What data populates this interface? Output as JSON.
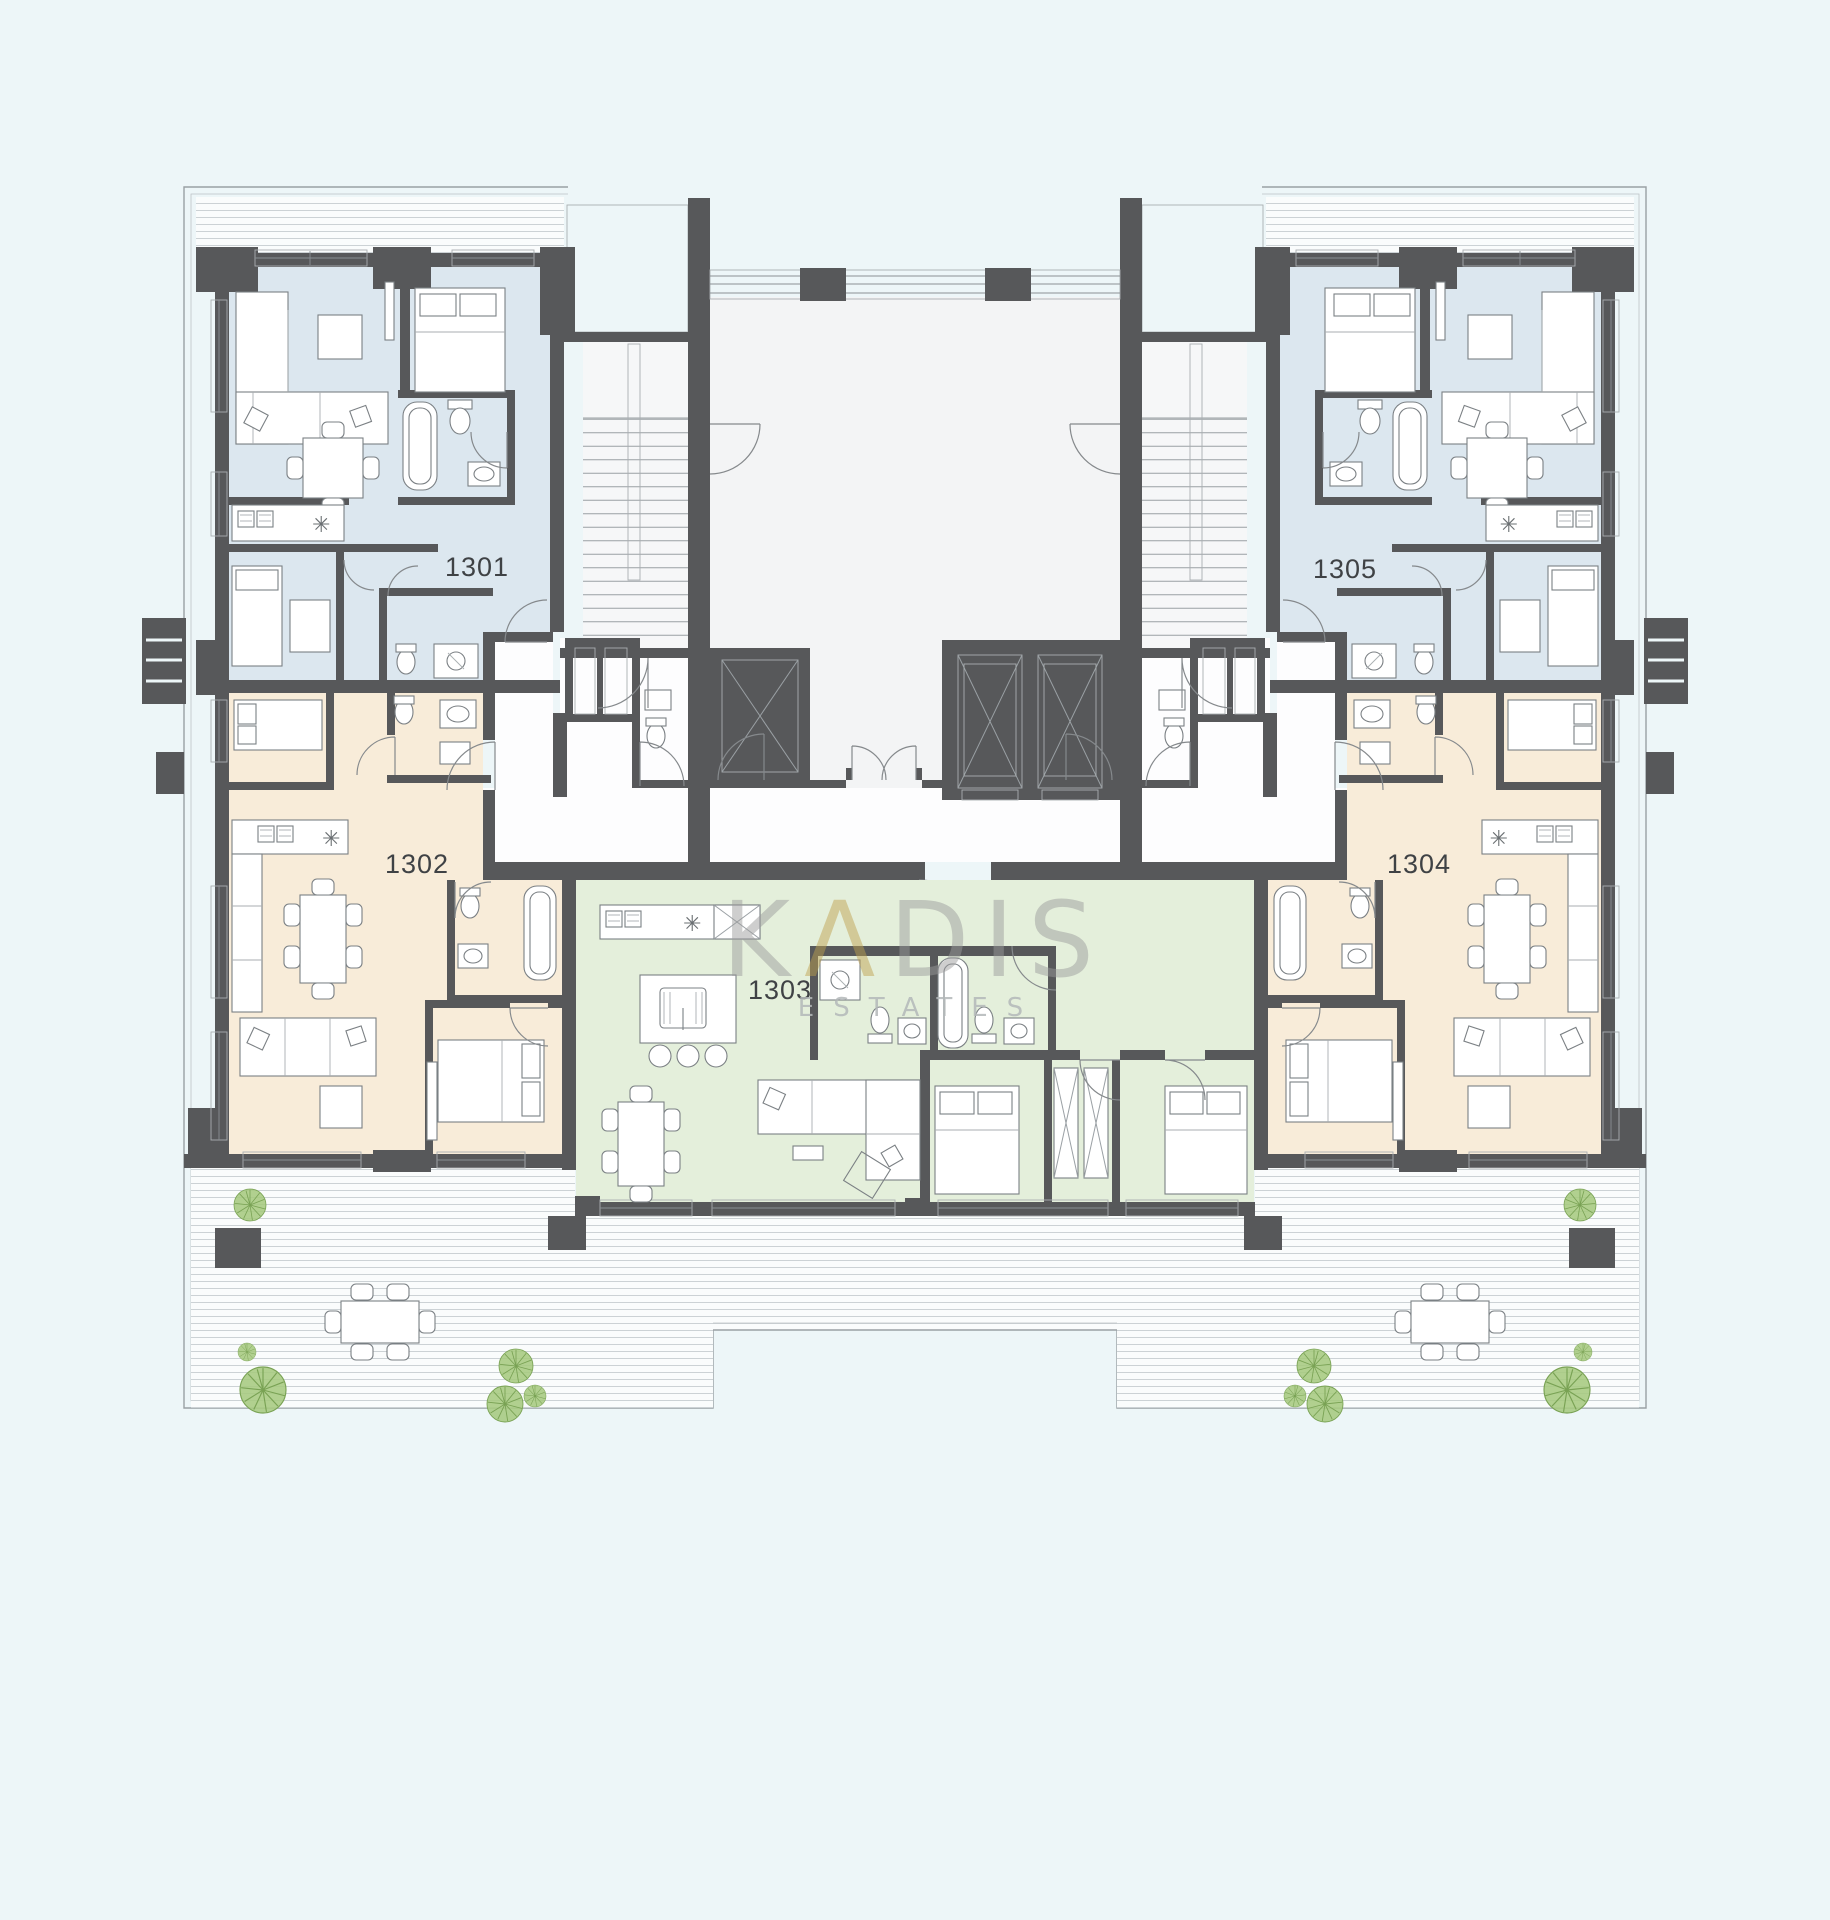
{
  "plan": {
    "background_color": "#edf6f8",
    "kitchen_symbol": "✳",
    "watermark": {
      "prefix": "K",
      "letter_a": "Λ",
      "suffix": "DIS",
      "subtitle": "ESTATES",
      "gray_color": "#9b9b9b",
      "gold_color": "#bfa14e"
    },
    "apartments": [
      {
        "number": "1301",
        "zone": "upper-left tower",
        "color": "#dce7ef"
      },
      {
        "number": "1302",
        "zone": "lower-left tower",
        "color": "#f8ecd9"
      },
      {
        "number": "1303",
        "zone": "center",
        "color": "#e4efdb"
      },
      {
        "number": "1304",
        "zone": "lower-right tower",
        "color": "#f8ecd9"
      },
      {
        "number": "1305",
        "zone": "upper-right tower",
        "color": "#dce7ef"
      }
    ],
    "colors": {
      "walls": "#57585a",
      "outline": "#9aa0a4",
      "deck_line": "#ccd2d5",
      "furniture_stroke": "#7b8084",
      "tree_fill": "#a6c980",
      "tree_stroke": "#79a254",
      "label_text": "#3f4245"
    }
  }
}
